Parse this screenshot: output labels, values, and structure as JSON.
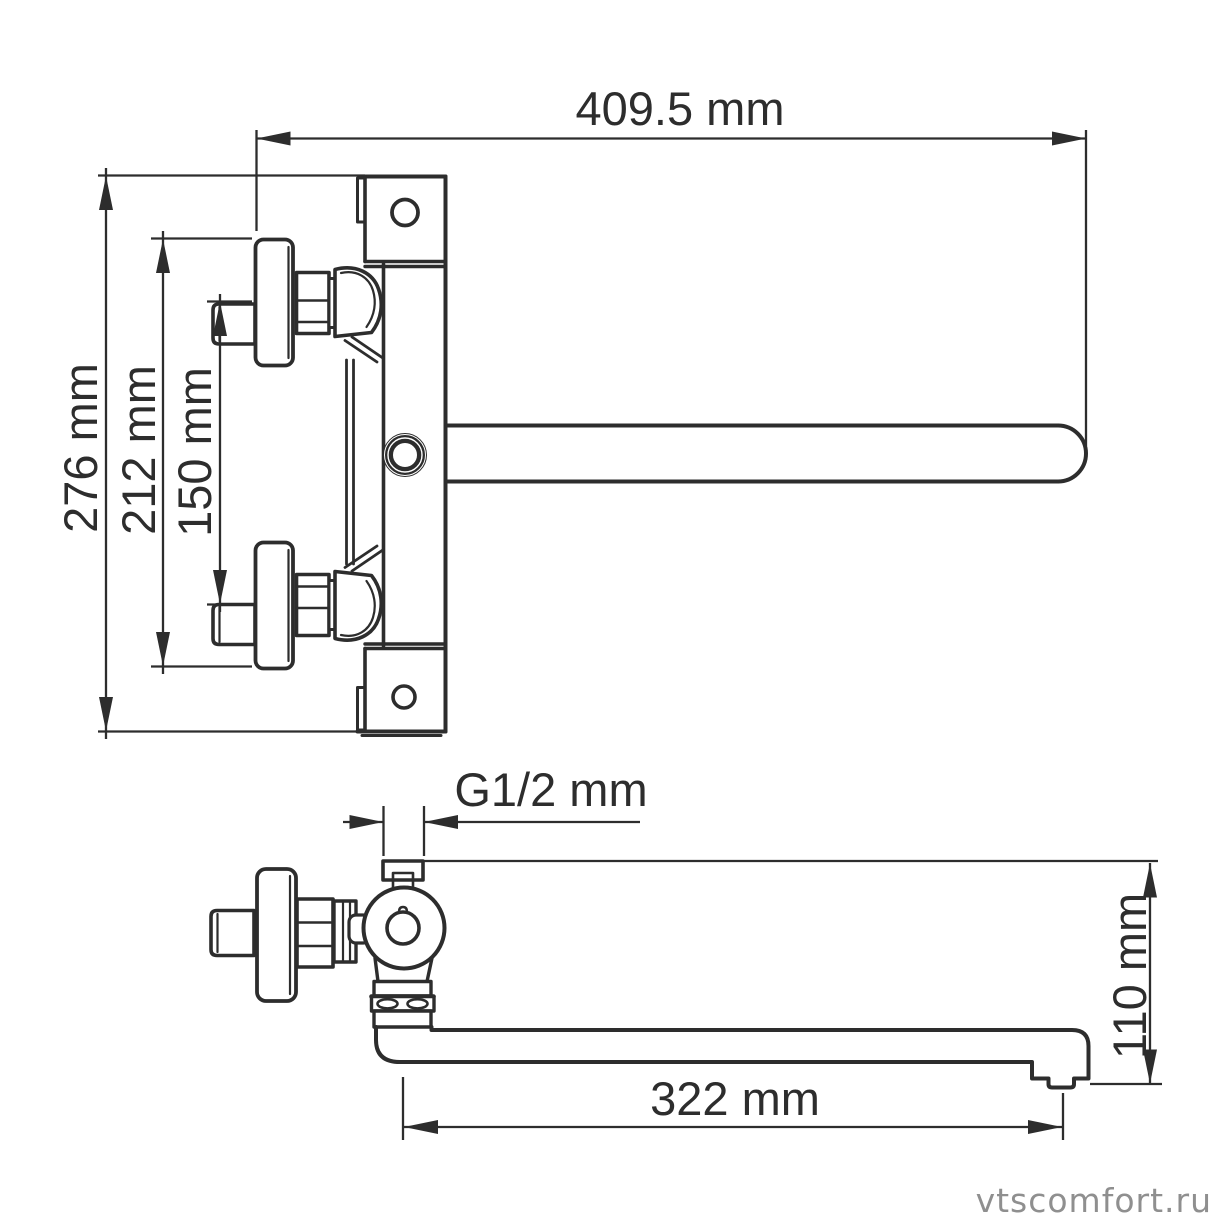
{
  "drawing": {
    "subject": "wall-mounted-bath-mixer-faucet",
    "views": {
      "front": "front-view-with-spout",
      "side": "side-profile-view"
    },
    "line_color": "#2d2d2d",
    "background_color": "#ffffff",
    "dimensions": {
      "overall_width": "409.5 mm",
      "overall_height": "276 mm",
      "flange_span": "212 mm",
      "inlet_spacing": "150 mm",
      "thread": "G1/2 mm",
      "spout_reach": "322 mm",
      "spout_drop": "110 mm"
    }
  },
  "watermark": {
    "text": "vtscomfort.ru",
    "color": "#8f8f8f"
  }
}
